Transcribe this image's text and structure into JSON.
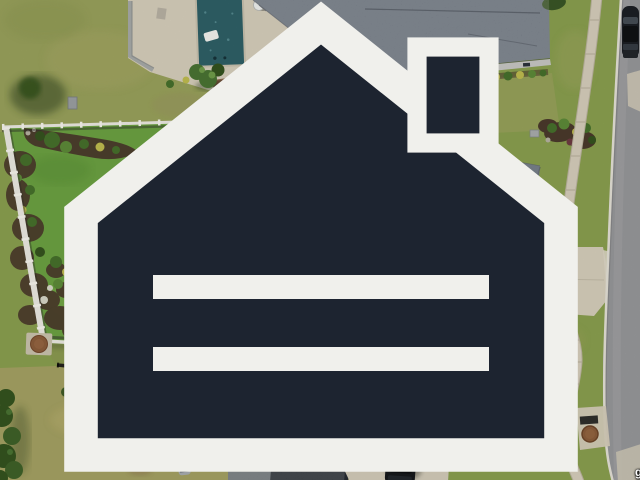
{
  "watermark": {
    "text": "ggarMLS",
    "tm": "™",
    "icon": "mls-house-logo-icon"
  },
  "scene": {
    "type": "aerial-drone-photo",
    "description": "Top-down drone photo of a suburban lot: large gray shingle roof home with concrete patio and fenced green backyard with curved mulch planting beds; neighbor's rectangular swimming pool and gray roof at top; neighbor play yard at bottom left with trampoline, kiddie pool and yellow slide; second neighbor roof, metal shed and black SUV at bottom; curved sidewalk, grass strip, curb and asphalt street along the right edge with a parked car at top right.",
    "objects": [
      "main-house-roof",
      "porch-roof",
      "concrete-patio",
      "grill",
      "fire-pit",
      "lounge-chairs",
      "backyard-lawn",
      "mulch-beds-with-shrubs",
      "white-vinyl-fence",
      "black-metal-fence",
      "swimming-pool",
      "pool-float",
      "pool-deck",
      "satellite-dish",
      "top-neighbor-roof",
      "shrub-row",
      "wood-deck-platform",
      "trees",
      "stepping-stones",
      "driveway",
      "front-lawn",
      "sidewalk",
      "street",
      "curb",
      "parked-car",
      "storm-drain",
      "manhole-cover",
      "bottom-neighbor-roof",
      "metal-shed",
      "suv",
      "trampoline",
      "kiddie-pool",
      "yellow-slide",
      "inflatable-toy",
      "play-yard",
      "street-tree"
    ]
  },
  "palette": {
    "grass-base": "#8aa04f",
    "grass-main": "#6ca242",
    "grass-olive": "#99a25c",
    "grass-tan": "#b3a96c",
    "play-yard": "#a5a263",
    "concrete": "#d7cfbc",
    "concrete-bright": "#ded7c5",
    "pool-water": "#2f6067",
    "pool-speckle": "#558a90",
    "roof-main": "#636c78",
    "roof-main-light": "#737d89",
    "porch-roof": "#818992",
    "roof-top-house": "#6e7681",
    "roof-bottom": "#6d7377",
    "roof-bottom-light": "#9fa5a8",
    "roof-bottom-dark": "#262b31",
    "siding": "#c8c8c4",
    "street": "#98999b",
    "curb": "#e6e2d8",
    "mulch": "#4b3a2c",
    "shrub-green": "#46702c",
    "shrub-mid": "#5d8a38",
    "shrub-dark": "#35531f",
    "shrub-yellow": "#c0bd4f",
    "shrub-burgundy": "#6d3b41",
    "tree-green": "#4a7433",
    "tree-dark": "#34531f",
    "shadow": "#2c3c1c",
    "fence-white": "#eceae2",
    "fence-shadow": "#2f2f2a",
    "fence-black": "#23211d",
    "deck-wood": "#6d4e38",
    "trampoline": "#1a202a",
    "kiddie-pool-rim": "#e7ecec",
    "kiddie-pool-water": "#6cb0d2",
    "slide-yellow": "#d3d95d",
    "slide-orange": "#df8133",
    "inflatable": "#c9d84f",
    "car-dark": "#1c1f24",
    "suv-dark": "#16181c",
    "manhole": "#8b5d3b",
    "watermark-white": "#ffffff"
  }
}
